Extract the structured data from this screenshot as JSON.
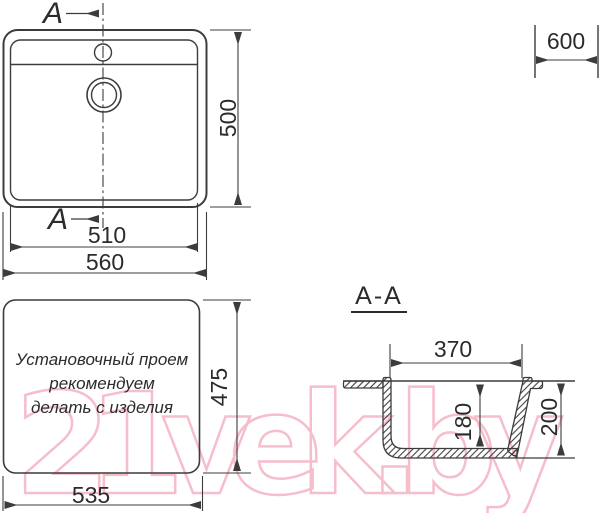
{
  "colors": {
    "line": "#3c3c3c",
    "text": "#2b2b2b",
    "watermark_pink": "#f6becb",
    "background": "#ffffff"
  },
  "watermark": {
    "text": "21vek.by"
  },
  "top_view": {
    "section_arrow_top_label": "A",
    "section_arrow_bottom_label": "A",
    "dim_depth": "500",
    "dim_bowl_width": "510",
    "dim_overall_width": "560",
    "dim_countertop_width": "600"
  },
  "install_opening": {
    "note_lines": [
      "Установочный проем",
      "рекомендуем",
      "делать с изделия"
    ],
    "dim_height": "475",
    "dim_width": "535"
  },
  "section": {
    "title": "A-A",
    "dim_opening_width": "370",
    "dim_inner_depth": "180",
    "dim_overall_depth": "200"
  }
}
